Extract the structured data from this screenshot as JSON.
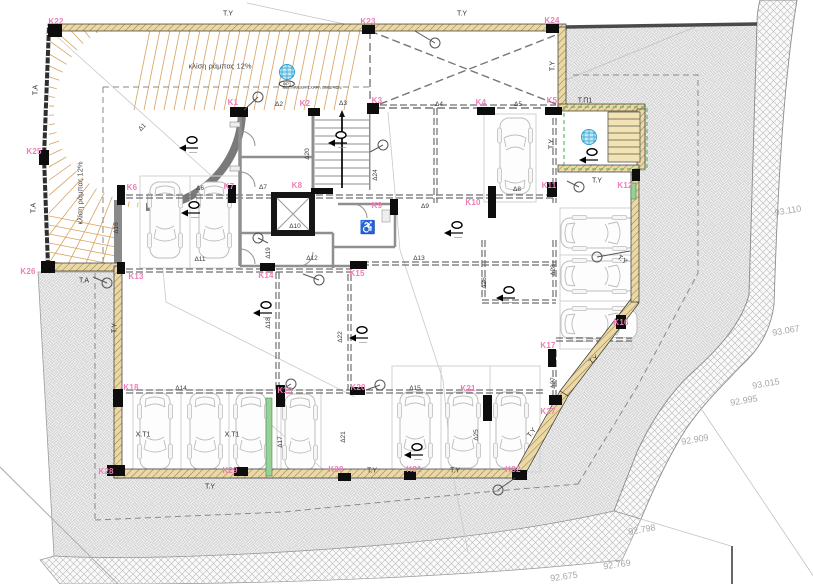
{
  "plan": {
    "colors": {
      "accent_pink": "#ee7db8",
      "wall_tan": "#ead9a6",
      "drain_blue": "#bfe8f7",
      "green_strip": "#98d09a",
      "dashed_grey": "#6f6f6f"
    },
    "column_labels": [
      {
        "t": "K1",
        "x": 233,
        "y": 103
      },
      {
        "t": "K2",
        "x": 305,
        "y": 104
      },
      {
        "t": "K3",
        "x": 377,
        "y": 101
      },
      {
        "t": "K4",
        "x": 481,
        "y": 103
      },
      {
        "t": "K5",
        "x": 552,
        "y": 101
      },
      {
        "t": "K6",
        "x": 132,
        "y": 188
      },
      {
        "t": "K7",
        "x": 229,
        "y": 187
      },
      {
        "t": "K8",
        "x": 297,
        "y": 186
      },
      {
        "t": "K9",
        "x": 377,
        "y": 206
      },
      {
        "t": "K10",
        "x": 473,
        "y": 203
      },
      {
        "t": "K11",
        "x": 549,
        "y": 186
      },
      {
        "t": "K12",
        "x": 625,
        "y": 186
      },
      {
        "t": "K13",
        "x": 136,
        "y": 277
      },
      {
        "t": "K14",
        "x": 266,
        "y": 276
      },
      {
        "t": "K15",
        "x": 357,
        "y": 274
      },
      {
        "t": "K16",
        "x": 621,
        "y": 323
      },
      {
        "t": "K17",
        "x": 548,
        "y": 346
      },
      {
        "t": "K18",
        "x": 131,
        "y": 388
      },
      {
        "t": "K19",
        "x": 285,
        "y": 391
      },
      {
        "t": "K20",
        "x": 358,
        "y": 388
      },
      {
        "t": "K21",
        "x": 468,
        "y": 389
      },
      {
        "t": "K22",
        "x": 56,
        "y": 22
      },
      {
        "t": "K23",
        "x": 368,
        "y": 22
      },
      {
        "t": "K24",
        "x": 552,
        "y": 21
      },
      {
        "t": "K25",
        "x": 34,
        "y": 152
      },
      {
        "t": "K26",
        "x": 28,
        "y": 272
      },
      {
        "t": "K27",
        "x": 548,
        "y": 412
      },
      {
        "t": "K28",
        "x": 106,
        "y": 472
      },
      {
        "t": "K29",
        "x": 230,
        "y": 471
      },
      {
        "t": "K30",
        "x": 336,
        "y": 470
      },
      {
        "t": "K31",
        "x": 414,
        "y": 470
      },
      {
        "t": "K32",
        "x": 513,
        "y": 470
      }
    ],
    "dim_labels": [
      {
        "t": "Δ1",
        "x": 143,
        "y": 128,
        "r": -45
      },
      {
        "t": "Δ2",
        "x": 279,
        "y": 105
      },
      {
        "t": "Δ3",
        "x": 343,
        "y": 104
      },
      {
        "t": "Δ4",
        "x": 439,
        "y": 105
      },
      {
        "t": "Δ5",
        "x": 518,
        "y": 105
      },
      {
        "t": "Δ6",
        "x": 200,
        "y": 189
      },
      {
        "t": "Δ7",
        "x": 263,
        "y": 188
      },
      {
        "t": "Δ8",
        "x": 517,
        "y": 190
      },
      {
        "t": "Δ9",
        "x": 425,
        "y": 207
      },
      {
        "t": "Δ10",
        "x": 295,
        "y": 227
      },
      {
        "t": "Δ11",
        "x": 200,
        "y": 260
      },
      {
        "t": "Δ12",
        "x": 312,
        "y": 259
      },
      {
        "t": "Δ13",
        "x": 419,
        "y": 259
      },
      {
        "t": "Δ14",
        "x": 181,
        "y": 389
      },
      {
        "t": "Δ15",
        "x": 415,
        "y": 389
      },
      {
        "t": "Δ16",
        "x": 117,
        "y": 228,
        "r": -90
      },
      {
        "t": "Δ17",
        "x": 281,
        "y": 442,
        "r": -90
      },
      {
        "t": "Δ18",
        "x": 269,
        "y": 323,
        "r": -90
      },
      {
        "t": "Δ19",
        "x": 269,
        "y": 253,
        "r": -90
      },
      {
        "t": "Δ20",
        "x": 308,
        "y": 154,
        "r": -90
      },
      {
        "t": "Δ21",
        "x": 344,
        "y": 437,
        "r": -90
      },
      {
        "t": "Δ22",
        "x": 341,
        "y": 337,
        "r": -90
      },
      {
        "t": "Δ24",
        "x": 376,
        "y": 175,
        "r": -90
      },
      {
        "t": "Δ25",
        "x": 477,
        "y": 435,
        "r": -90
      },
      {
        "t": "Δ26",
        "x": 485,
        "y": 283,
        "r": -90
      },
      {
        "t": "Δ27",
        "x": 554,
        "y": 383,
        "r": -90
      },
      {
        "t": "Δ28",
        "x": 554,
        "y": 270,
        "r": -90
      }
    ],
    "wall_labels": [
      {
        "t": "T.Y",
        "x": 228,
        "y": 14
      },
      {
        "t": "T.Y",
        "x": 462,
        "y": 14
      },
      {
        "t": "T.A",
        "x": 36,
        "y": 90,
        "r": -90
      },
      {
        "t": "T.A",
        "x": 34,
        "y": 208,
        "r": -90
      },
      {
        "t": "T.A",
        "x": 84,
        "y": 281
      },
      {
        "t": "T.Y",
        "x": 553,
        "y": 66,
        "r": -90
      },
      {
        "t": "T.Y",
        "x": 552,
        "y": 144,
        "r": -90
      },
      {
        "t": "T.Π1",
        "x": 585,
        "y": 101
      },
      {
        "t": "T.Y",
        "x": 597,
        "y": 181
      },
      {
        "t": "T.Y",
        "x": 622,
        "y": 260,
        "r": 35
      },
      {
        "t": "T.Y",
        "x": 594,
        "y": 360,
        "r": -40
      },
      {
        "t": "T.Y",
        "x": 115,
        "y": 328,
        "r": -90
      },
      {
        "t": "T.Y",
        "x": 210,
        "y": 487
      },
      {
        "t": "T.Y",
        "x": 372,
        "y": 471
      },
      {
        "t": "T.Y",
        "x": 455,
        "y": 471
      },
      {
        "t": "T.Y",
        "x": 532,
        "y": 433,
        "r": -52
      },
      {
        "t": "X.T1",
        "x": 143,
        "y": 435
      },
      {
        "t": "X.T1",
        "x": 232,
        "y": 435
      }
    ],
    "slope_labels": [
      {
        "t": "κλίση ράμπας 12%",
        "x": 220,
        "y": 66
      },
      {
        "t": "κλίση ράμπας 12%",
        "x": 80,
        "y": 193,
        "r": -90
      }
    ],
    "elevation_labels": [
      {
        "t": "93.110",
        "x": 788,
        "y": 211,
        "r": -10
      },
      {
        "t": "93.067",
        "x": 786,
        "y": 331,
        "r": -10
      },
      {
        "t": "93.015",
        "x": 766,
        "y": 384,
        "r": -10
      },
      {
        "t": "92.995",
        "x": 744,
        "y": 401,
        "r": -10
      },
      {
        "t": "92.909",
        "x": 695,
        "y": 440,
        "r": -10
      },
      {
        "t": "92.798",
        "x": 642,
        "y": 530,
        "r": -10
      },
      {
        "t": "92.769",
        "x": 617,
        "y": 565,
        "r": -8
      },
      {
        "t": "92.675",
        "x": 564,
        "y": 577,
        "r": -8
      }
    ],
    "notes": [
      {
        "t": "ΜΕΤΑΛΛΙΚΗ ΣΧΑΡΑ ΟΜΒΡΙΩΝ",
        "x": 312,
        "y": 88
      }
    ],
    "badges": [
      {
        "t": "ΦΡ1",
        "x": 287,
        "y": 84
      }
    ],
    "icons": [
      {
        "t": "♿",
        "x": 368,
        "y": 227
      }
    ]
  }
}
